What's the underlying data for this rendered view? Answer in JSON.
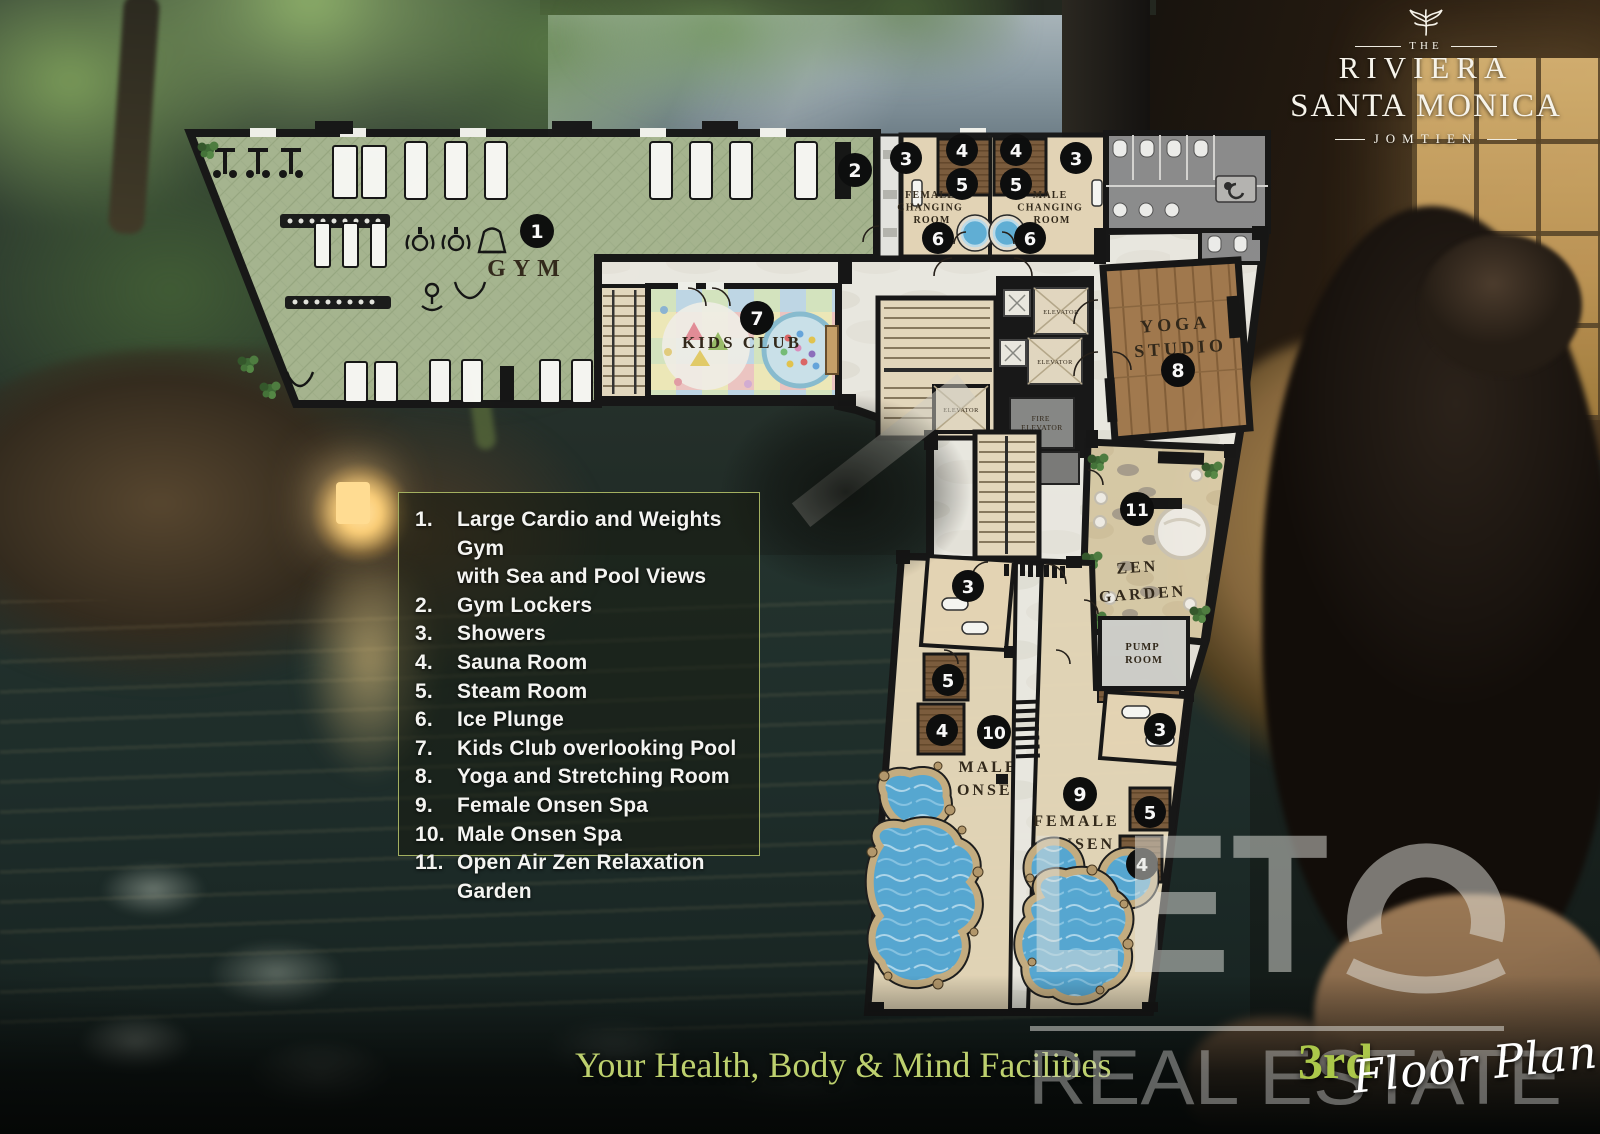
{
  "brand": {
    "pre": "THE",
    "name": "RIVIERA",
    "sub": "SANTA MONICA",
    "location": "JOMTIEN"
  },
  "legend": {
    "items": [
      {
        "num": "1.",
        "lines": [
          "Large Cardio and Weights Gym",
          "with Sea and Pool Views"
        ]
      },
      {
        "num": "2.",
        "lines": [
          "Gym Lockers"
        ]
      },
      {
        "num": "3.",
        "lines": [
          "Showers"
        ]
      },
      {
        "num": "4.",
        "lines": [
          "Sauna Room"
        ]
      },
      {
        "num": "5.",
        "lines": [
          "Steam Room"
        ]
      },
      {
        "num": "6.",
        "lines": [
          "Ice Plunge"
        ]
      },
      {
        "num": "7.",
        "lines": [
          "Kids Club overlooking Pool"
        ]
      },
      {
        "num": "8.",
        "lines": [
          "Yoga and Stretching Room"
        ]
      },
      {
        "num": "9.",
        "lines": [
          "Female Onsen Spa"
        ]
      },
      {
        "num": "10.",
        "lines": [
          "Male Onsen Spa"
        ]
      },
      {
        "num": "11.",
        "lines": [
          "Open Air Zen Relaxation Garden"
        ]
      }
    ]
  },
  "plan": {
    "labels": {
      "gym": "GYM",
      "female_changing": [
        "FEMALE",
        "CHANGING",
        "ROOM"
      ],
      "male_changing": [
        "MALE",
        "CHANGING",
        "ROOM"
      ],
      "kids_club": "KIDS CLUB",
      "yoga": [
        "YOGA",
        "STUDIO"
      ],
      "zen": [
        "ZEN",
        "GARDEN"
      ],
      "pump": [
        "PUMP",
        "ROOM"
      ],
      "male_onsen": [
        "MALE",
        "ONSEN"
      ],
      "female_onsen": [
        "FEMALE",
        "ONSEN"
      ],
      "elevator": "ELEVATOR",
      "fire_elevator": [
        "FIRE",
        "ELEVATOR"
      ]
    },
    "badges": [
      "1",
      "2",
      "3",
      "4",
      "5",
      "4",
      "5",
      "3",
      "6",
      "6",
      "7",
      "8",
      "11",
      "3",
      "5",
      "4",
      "10",
      "3",
      "9",
      "5",
      "4"
    ]
  },
  "footer": {
    "title": "Your Health, Body & Mind Facilities",
    "floor": "3rd",
    "plan_script": "Floor Plan"
  },
  "watermark": {
    "word": "LETO",
    "prefix": "LET",
    "sub": "REAL ESTATE"
  }
}
